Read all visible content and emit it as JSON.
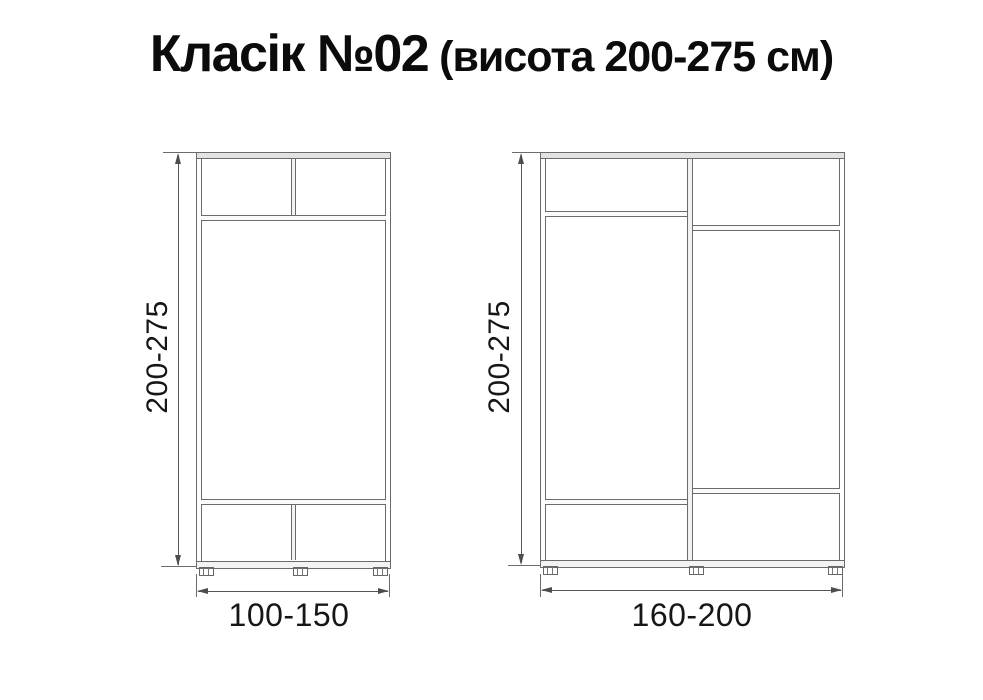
{
  "title": {
    "main": "Класік №02",
    "suffix": " (висота 200-275 см)"
  },
  "colors": {
    "background": "#ffffff",
    "cabinet_line": "#6b6b6b",
    "dimension_line": "#565656",
    "panel_fill": "#e2e2e2",
    "text": "#111111"
  },
  "diagrams": [
    {
      "id": "small-wardrobe",
      "height_label": "200-275",
      "width_label": "100-150"
    },
    {
      "id": "large-wardrobe",
      "height_label": "200-275",
      "width_label": "160-200"
    }
  ]
}
